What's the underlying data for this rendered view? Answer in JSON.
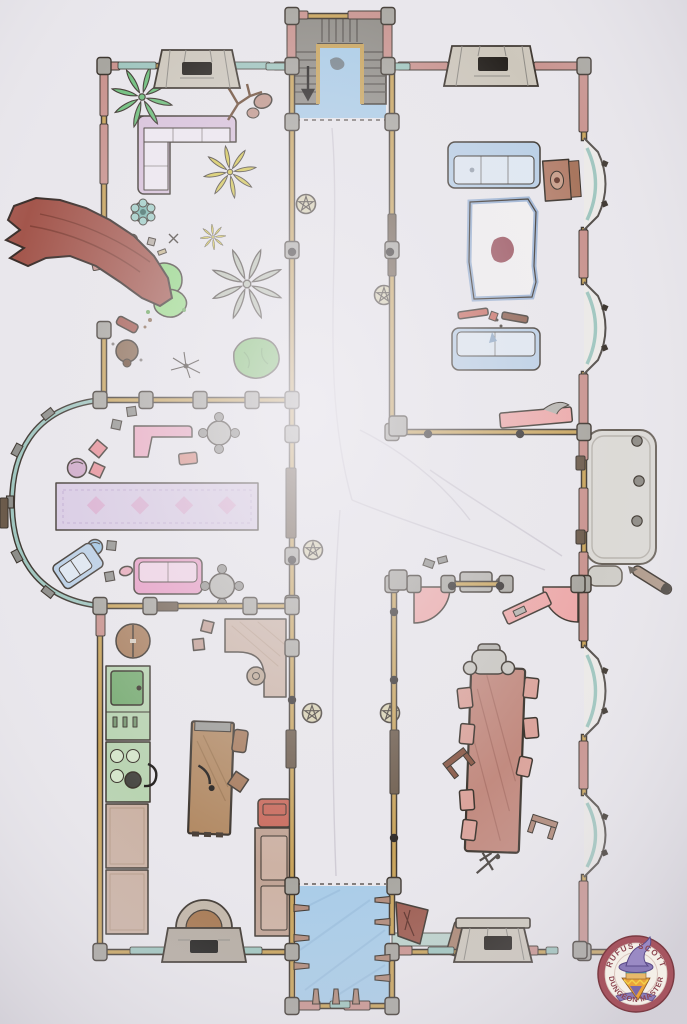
{
  "badge": {
    "top_text": "RUFUS SCOTT",
    "bottom_text": "DUNGEON MASTER"
  },
  "palette": {
    "paper": "#e9e7ec",
    "ink": "#3d362f",
    "wall_tan": "#c9a45b",
    "wall_pink": "#c9938e",
    "glass_teal": "#9fc6bf",
    "floor_blue": "#a9cce8",
    "stone": "#cdc7bc",
    "gray_block": "#a8a6a0",
    "door_dark": "#6b5a4a",
    "torch_dark": "#2e2a28",
    "glyph_tan": "#d9d2b0",
    "sofa_lavender": "#d9c2dc",
    "cushion": "#efe9f2",
    "sofa_blue": "#b9cfe6",
    "cushion_blue": "#dfe8f2",
    "rug_lavender": "#d9cbe4",
    "rug_pink": "#d9a8cc",
    "pink_furn": "#eda8a8",
    "sofa_pink": "#e89bc4",
    "chair_pink": "#dba49c",
    "table_brown": "#b28a64",
    "dining_table": "#c28b80",
    "counter_green": "#b9d4b2",
    "sink_green": "#79ad74",
    "counter_tan": "#cbb2a4",
    "wood_red": "#a3564c",
    "plant_green": "#6fc07d",
    "plant_yellow": "#d6c84a",
    "plant_gray": "#b9c1b0",
    "bush_green": "#74bd62",
    "badge_ring": "#a65560",
    "badge_text": "#8c4550",
    "hat_purple": "#8b7cb8",
    "face_orange": "#eaa33c"
  },
  "map": {
    "walls": [
      "M104,66 H292",
      "M104,66 V240",
      "M104,330 V402",
      "M100,400 H292",
      "M292,66 V886",
      "M292,16 V66",
      "M388,16 V66",
      "M292,16 H388",
      "M392,66 V432",
      "M392,66 H584",
      "M584,66 V138",
      "M584,230 V282",
      "M584,374 V432",
      "M392,432 H584",
      "M584,432 V584",
      "M392,584 H414",
      "M450,584 H506",
      "M578,584 H586",
      "M394,584 V886",
      "M584,584 V645",
      "M584,737 V793",
      "M584,877 V952",
      "M392,952 H544",
      "M580,952 H608",
      "M100,606 H292",
      "M100,606 V952",
      "M100,952 H292",
      "M292,886 V1006",
      "M292,1006 H392",
      "M392,886 V932",
      "M392,952 V1006"
    ],
    "pink_segments": [
      [
        100,
        70,
        8,
        46
      ],
      [
        100,
        124,
        8,
        60
      ],
      [
        106,
        62,
        14,
        8
      ],
      [
        274,
        62,
        14,
        8
      ],
      [
        287,
        18,
        9,
        42
      ],
      [
        383,
        18,
        9,
        42
      ],
      [
        294,
        11,
        14,
        8
      ],
      [
        348,
        11,
        34,
        8
      ],
      [
        398,
        62,
        50,
        8
      ],
      [
        534,
        62,
        44,
        8
      ],
      [
        579,
        70,
        9,
        62
      ],
      [
        579,
        230,
        9,
        48
      ],
      [
        579,
        374,
        9,
        54
      ],
      [
        579,
        434,
        9,
        26
      ],
      [
        579,
        488,
        9,
        44
      ],
      [
        579,
        552,
        9,
        28
      ],
      [
        579,
        588,
        9,
        53
      ],
      [
        579,
        741,
        9,
        48
      ],
      [
        579,
        881,
        9,
        66
      ],
      [
        396,
        946,
        16,
        9
      ],
      [
        524,
        946,
        14,
        9
      ],
      [
        298,
        1001,
        22,
        9
      ],
      [
        344,
        1001,
        26,
        9
      ],
      [
        96,
        610,
        9,
        26
      ],
      [
        90,
        242,
        10,
        13,
        18
      ],
      [
        92,
        258,
        9,
        12,
        -12
      ]
    ],
    "teal_segments": [
      [
        118,
        62,
        38,
        7
      ],
      [
        234,
        62,
        36,
        7
      ],
      [
        266,
        63,
        24,
        7
      ],
      [
        388,
        63,
        22,
        7
      ],
      [
        450,
        62,
        16,
        7
      ],
      [
        130,
        947,
        38,
        7
      ],
      [
        234,
        947,
        28,
        7
      ],
      [
        428,
        947,
        26,
        7
      ],
      [
        546,
        947,
        12,
        7
      ],
      [
        330,
        1001,
        20,
        7
      ]
    ],
    "pillars": [
      [
        104,
        66
      ],
      [
        292,
        66
      ],
      [
        388,
        66
      ],
      [
        292,
        16
      ],
      [
        388,
        16
      ],
      [
        104,
        240
      ],
      [
        104,
        330
      ],
      [
        100,
        400
      ],
      [
        292,
        400
      ],
      [
        292,
        434
      ],
      [
        146,
        400
      ],
      [
        200,
        400
      ],
      [
        252,
        400
      ],
      [
        292,
        122
      ],
      [
        292,
        250
      ],
      [
        292,
        556
      ],
      [
        292,
        604
      ],
      [
        292,
        648
      ],
      [
        292,
        886
      ],
      [
        392,
        122
      ],
      [
        392,
        250
      ],
      [
        392,
        432
      ],
      [
        392,
        584
      ],
      [
        394,
        886
      ],
      [
        584,
        66
      ],
      [
        584,
        432
      ],
      [
        584,
        584
      ],
      [
        584,
        952
      ],
      [
        100,
        606
      ],
      [
        292,
        606
      ],
      [
        150,
        606
      ],
      [
        250,
        606
      ],
      [
        414,
        584
      ],
      [
        448,
        584
      ],
      [
        506,
        584
      ],
      [
        578,
        584
      ],
      [
        100,
        952
      ],
      [
        292,
        952
      ],
      [
        392,
        952
      ],
      [
        580,
        950
      ],
      [
        292,
        1006
      ],
      [
        392,
        1006
      ],
      [
        398,
        426,
        18,
        20
      ],
      [
        398,
        580,
        18,
        20
      ]
    ],
    "door_segments": [
      [
        286,
        468,
        10,
        70
      ],
      [
        286,
        730,
        10,
        38
      ],
      [
        388,
        214,
        8,
        62
      ],
      [
        390,
        730,
        9,
        64
      ],
      [
        148,
        602,
        30,
        9
      ],
      [
        576,
        456,
        9,
        14
      ],
      [
        576,
        530,
        9,
        14
      ],
      [
        0,
        498,
        8,
        30
      ]
    ],
    "torches": [
      [
        394,
        612
      ],
      [
        394,
        680
      ],
      [
        394,
        838
      ],
      [
        292,
        560
      ],
      [
        292,
        700
      ],
      [
        428,
        434
      ],
      [
        520,
        434
      ],
      [
        452,
        586
      ],
      [
        500,
        586
      ],
      [
        390,
        252
      ],
      [
        292,
        252
      ]
    ],
    "glyphs": [
      [
        306,
        204
      ],
      [
        384,
        295
      ],
      [
        313,
        550
      ],
      [
        312,
        713
      ],
      [
        390,
        713
      ]
    ],
    "stepping_stones": [
      [
        637,
        441
      ],
      [
        639,
        481
      ],
      [
        637,
        521
      ]
    ],
    "pool_pegs": [
      [
        292,
        908,
        0
      ],
      [
        292,
        938,
        0
      ],
      [
        292,
        966,
        0
      ],
      [
        392,
        900,
        180
      ],
      [
        392,
        922,
        180
      ],
      [
        392,
        958,
        180
      ],
      [
        392,
        978,
        180
      ],
      [
        316,
        1006,
        -90
      ],
      [
        336,
        1006,
        -90
      ],
      [
        356,
        1006,
        -90
      ]
    ],
    "curve_tabs": [
      [
        48,
        414,
        -38
      ],
      [
        17,
        450,
        -62
      ],
      [
        10,
        502,
        -90
      ],
      [
        17,
        556,
        62
      ],
      [
        48,
        592,
        38
      ]
    ],
    "trails": [
      "M332,128 C342,250 318,380 352,500",
      "M352,500 C400,520 480,545 545,570",
      "M340,510 C330,640 332,770 336,876",
      "M430,470 C470,498 520,528 562,556",
      "M360,430 C400,450 440,480 470,520"
    ],
    "thresholds": [
      "M296,120 H386",
      "M296,884 H386"
    ]
  }
}
